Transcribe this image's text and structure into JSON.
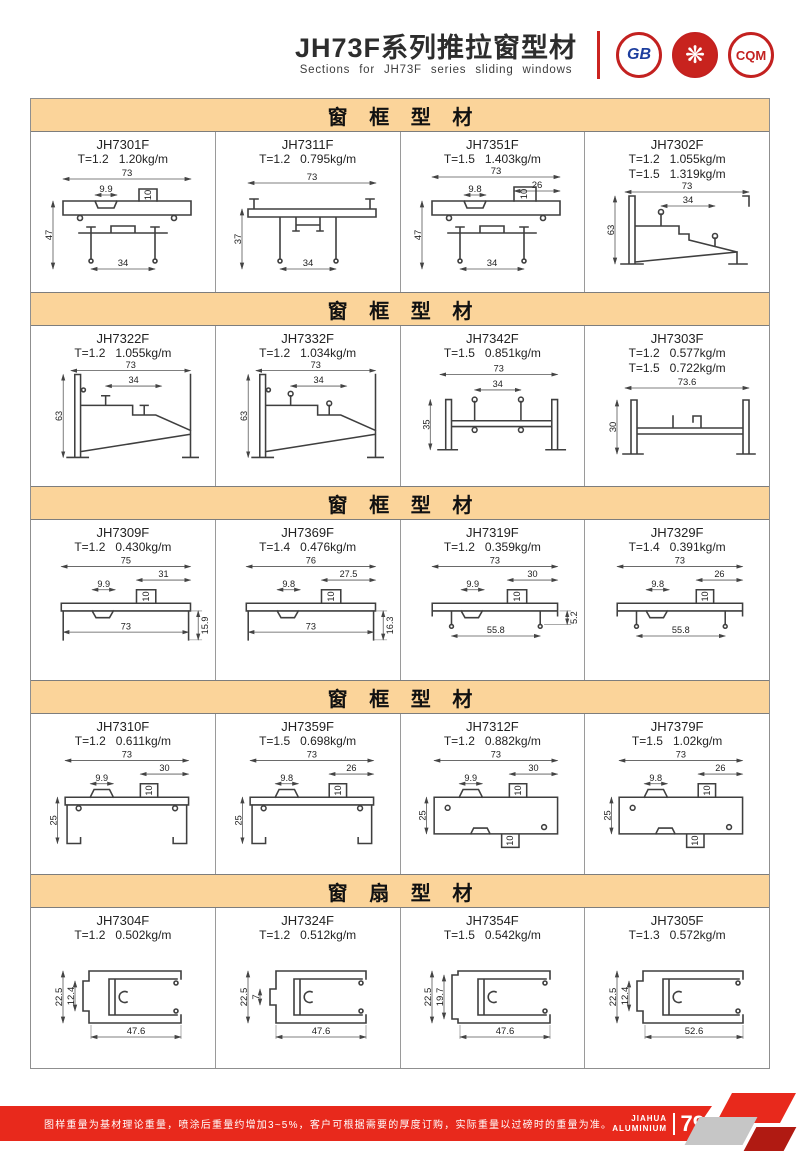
{
  "header": {
    "title": "JH73F系列推拉窗型材",
    "subtitle": "Sections for JH73F series sliding windows",
    "logos": [
      {
        "name": "gb-certification-logo",
        "text": "GB"
      },
      {
        "name": "quality-flower-logo",
        "text": "❋"
      },
      {
        "name": "cqm-certification-logo",
        "text": "CQM"
      }
    ]
  },
  "sections": [
    {
      "title": "窗 框 型 材",
      "profiles": [
        {
          "code": "JH7301F",
          "specs": [
            "T=1.2   1.20kg/m"
          ],
          "dims": [
            "73",
            "9.9",
            "10",
            "47",
            "34"
          ]
        },
        {
          "code": "JH7311F",
          "specs": [
            "T=1.2   0.795kg/m"
          ],
          "dims": [
            "73",
            "37",
            "34"
          ]
        },
        {
          "code": "JH7351F",
          "specs": [
            "T=1.5   1.403kg/m"
          ],
          "dims": [
            "73",
            "26",
            "9.8",
            "10",
            "47",
            "34"
          ]
        },
        {
          "code": "JH7302F",
          "specs": [
            "T=1.2   1.055kg/m",
            "T=1.5   1.319kg/m"
          ],
          "dims": [
            "73",
            "34",
            "63"
          ]
        }
      ]
    },
    {
      "title": "窗 框 型 材",
      "profiles": [
        {
          "code": "JH7322F",
          "specs": [
            "T=1.2   1.055kg/m"
          ],
          "dims": [
            "73",
            "34",
            "63"
          ]
        },
        {
          "code": "JH7332F",
          "specs": [
            "T=1.2   1.034kg/m"
          ],
          "dims": [
            "73",
            "34",
            "63"
          ]
        },
        {
          "code": "JH7342F",
          "specs": [
            "T=1.5   0.851kg/m"
          ],
          "dims": [
            "73",
            "34",
            "35"
          ]
        },
        {
          "code": "JH7303F",
          "specs": [
            "T=1.2   0.577kg/m",
            "T=1.5   0.722kg/m"
          ],
          "dims": [
            "73.6",
            "30"
          ]
        }
      ]
    },
    {
      "title": "窗 框 型 材",
      "profiles": [
        {
          "code": "JH7309F",
          "specs": [
            "T=1.2   0.430kg/m"
          ],
          "dims": [
            "75",
            "31",
            "9.9",
            "10",
            "73",
            "15.9"
          ]
        },
        {
          "code": "JH7369F",
          "specs": [
            "T=1.4   0.476kg/m"
          ],
          "dims": [
            "76",
            "27.5",
            "9.8",
            "10",
            "73",
            "16.3"
          ]
        },
        {
          "code": "JH7319F",
          "specs": [
            "T=1.2   0.359kg/m"
          ],
          "dims": [
            "73",
            "30",
            "9.9",
            "10",
            "55.8",
            "5.2"
          ]
        },
        {
          "code": "JH7329F",
          "specs": [
            "T=1.4   0.391kg/m"
          ],
          "dims": [
            "73",
            "26",
            "9.8",
            "10",
            "55.8"
          ]
        }
      ]
    },
    {
      "title": "窗 框 型 材",
      "profiles": [
        {
          "code": "JH7310F",
          "specs": [
            "T=1.2   0.611kg/m"
          ],
          "dims": [
            "73",
            "30",
            "9.9",
            "10",
            "25"
          ]
        },
        {
          "code": "JH7359F",
          "specs": [
            "T=1.5   0.698kg/m"
          ],
          "dims": [
            "73",
            "26",
            "9.8",
            "10",
            "25"
          ]
        },
        {
          "code": "JH7312F",
          "specs": [
            "T=1.2   0.882kg/m"
          ],
          "dims": [
            "73",
            "30",
            "9.9",
            "10",
            "25",
            "10"
          ]
        },
        {
          "code": "JH7379F",
          "specs": [
            "T=1.5   1.02kg/m"
          ],
          "dims": [
            "73",
            "26",
            "9.8",
            "10",
            "25",
            "10"
          ]
        }
      ]
    },
    {
      "title": "窗 扇 型 材",
      "profiles": [
        {
          "code": "JH7304F",
          "specs": [
            "T=1.2   0.502kg/m"
          ],
          "dims": [
            "22.5",
            "12.4",
            "47.6"
          ]
        },
        {
          "code": "JH7324F",
          "specs": [
            "T=1.2   0.512kg/m"
          ],
          "dims": [
            "22.5",
            "7",
            "47.6"
          ]
        },
        {
          "code": "JH7354F",
          "specs": [
            "T=1.5   0.542kg/m"
          ],
          "dims": [
            "22.5",
            "19.7",
            "47.6"
          ]
        },
        {
          "code": "JH7305F",
          "specs": [
            "T=1.3   0.572kg/m"
          ],
          "dims": [
            "22.5",
            "12.4",
            "52.6"
          ]
        }
      ]
    }
  ],
  "footer": {
    "note": "图样重量为基材理论重量，喷涂后重量约增加3~5%，客户可根据需要的厚度订购，实际重量以过磅时的重量为准。",
    "brand_line1": "JIAHUA",
    "brand_line2": "ALUMINIUM",
    "page_number": "79"
  },
  "colors": {
    "accent_red": "#e8291c",
    "section_bar": "#fbd49a"
  }
}
